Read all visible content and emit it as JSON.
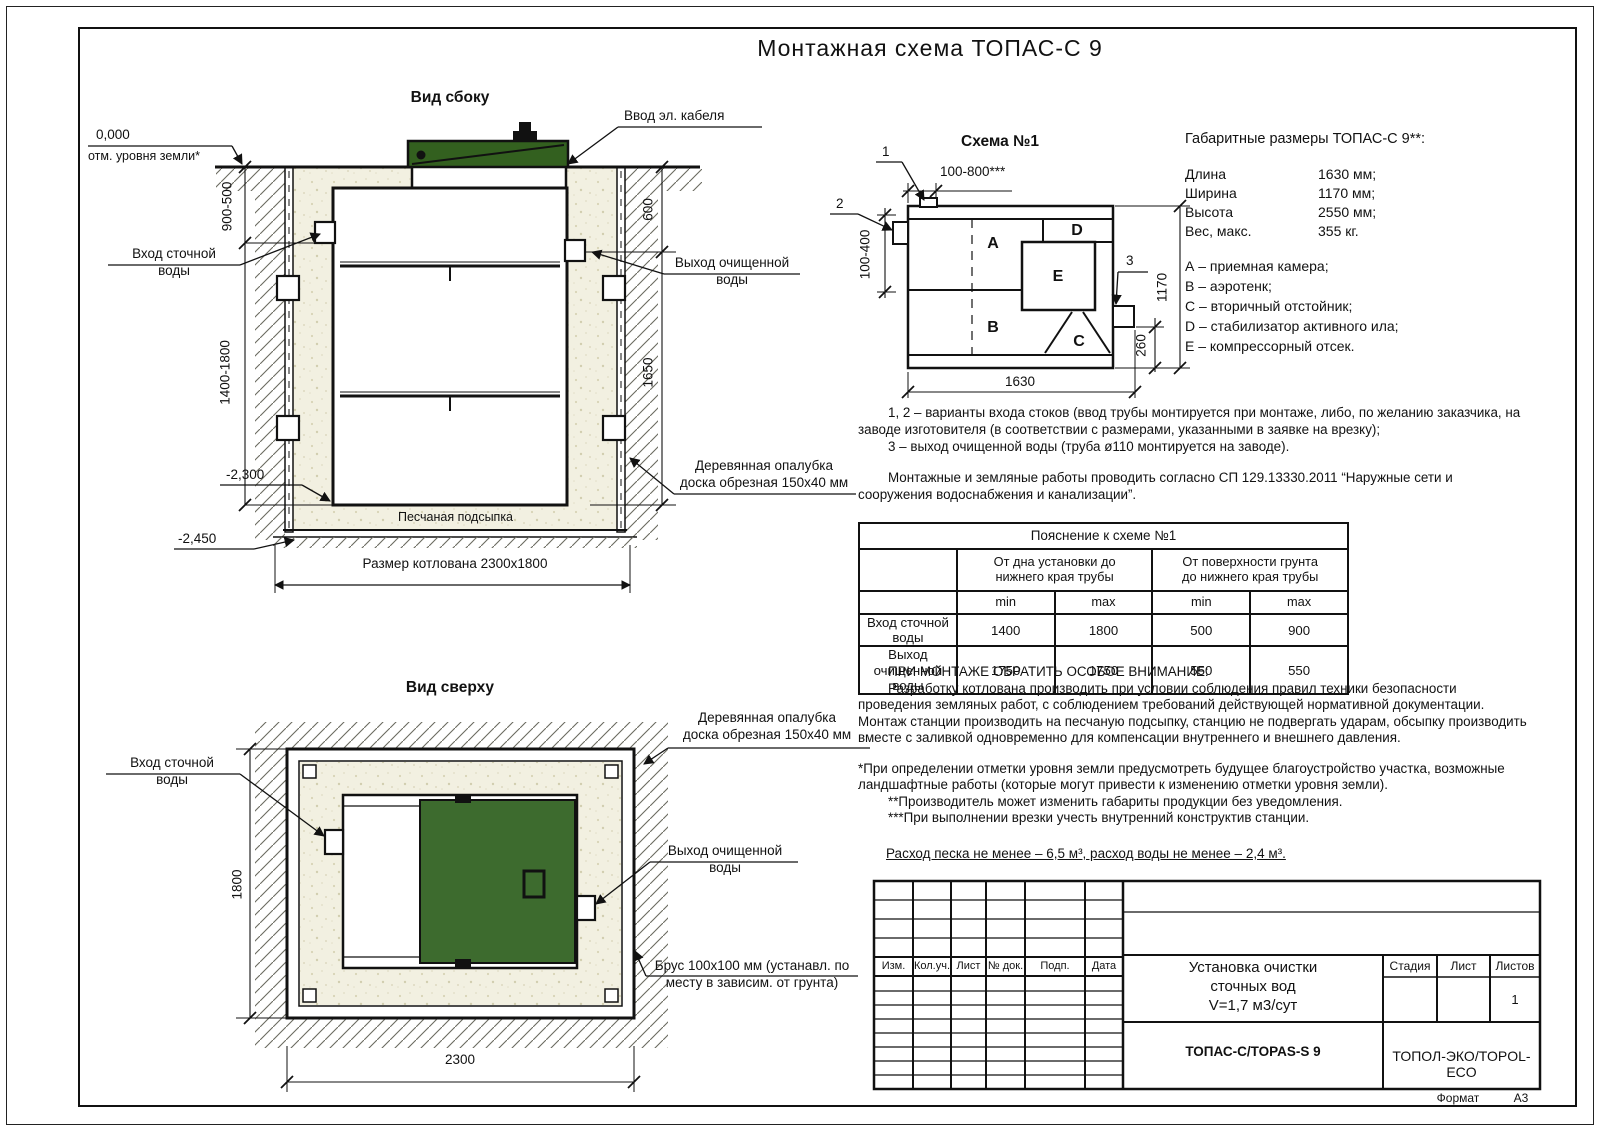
{
  "title": "Монтажная схема ТОПАС-С 9",
  "side_view": {
    "title": "Вид сбоку",
    "labels": {
      "zero_mark": "0,000",
      "ground_level": "отм. уровня земли*",
      "inlet": "Вход сточной\nводы",
      "cable_entry": "Ввод эл. кабеля",
      "outlet": "Выход очищенной\nводы",
      "formwork": "Деревянная опалубка\nдоска обрезная 150х40 мм",
      "sand_bed": "Песчаная подсыпка",
      "pit_size": "Размер котлована 2300х1800"
    },
    "dims": {
      "left_top": "900-500",
      "left_bottom": "1400-1800",
      "right_top": "600",
      "right_bottom": "1650",
      "depth_tank": "-2,300",
      "depth_pit": "-2,450"
    }
  },
  "top_view": {
    "title": "Вид сверху",
    "labels": {
      "inlet": "Вход сточной\nводы",
      "formwork": "Деревянная опалубка\nдоска обрезная 150х40 мм",
      "outlet": "Выход очищенной\nводы",
      "timber": "Брус 100х100 мм (устанавл. по\nместу в зависим. от грунта)"
    },
    "dims": {
      "width": "2300",
      "height": "1800"
    }
  },
  "schema1": {
    "title": "Схема №1",
    "callout1": "1",
    "callout2": "2",
    "callout3": "3",
    "letters": {
      "a": "A",
      "b": "B",
      "c": "C",
      "d": "D",
      "e": "E"
    },
    "dims": {
      "top": "100-800***",
      "left": "100-400",
      "right": "1170",
      "right2": "260",
      "bottom": "1630"
    }
  },
  "overall": {
    "title": "Габаритные размеры ТОПАС-С 9**:",
    "rows": [
      {
        "name": "Длина",
        "value": "1630 мм;"
      },
      {
        "name": "Ширина",
        "value": "1170 мм;"
      },
      {
        "name": "Высота",
        "value": "2550 мм;"
      },
      {
        "name": "Вес, макс.",
        "value": "355 кг."
      }
    ],
    "legend": [
      "А – приемная камера;",
      "В – аэротенк;",
      "С – вторичный отстойник;",
      "D – стабилизатор активного ила;",
      "Е – компрессорный отсек."
    ]
  },
  "notes": {
    "variants": "1, 2 – варианты входа  стоков (ввод трубы монтируется при монтаже, либо, по желанию заказчика, на заводе изготовителя (в соответствии с размерами, указанными в заявке на врезку);",
    "outlet_note": "3 – выход очищенной воды (труба ø110 монтируется на заводе).",
    "sp_note": "Монтажные и земляные работы проводить согласно СП 129.13330.2011 “Наружные сети и сооружения водоснабжения и канализации”."
  },
  "table": {
    "title": "Пояснение к схеме №1",
    "col_group1": "От дна установки до\nнижнего края трубы",
    "col_group2": "От поверхности грунта\nдо нижнего края трубы",
    "sub_headers": [
      "min",
      "max",
      "min",
      "max"
    ],
    "rows": [
      {
        "name": "Вход сточной воды",
        "values": [
          "1400",
          "1800",
          "500",
          "900"
        ]
      },
      {
        "name": "Выход очищенной воды",
        "values": [
          "1750",
          "1750",
          "550",
          "550"
        ]
      }
    ]
  },
  "attention": {
    "heading": "ПРИ МОНТАЖЕ ОБРАТИТЬ ОСОБОЕ ВНИМАНИЕ:",
    "p1": "Разработку котлована производить при условии соблюдения правил техники безопасности проведения земляных работ, с соблюдением требований действующей нормативной документации. Монтаж станции производить на песчаную подсыпку, станцию не подвергать ударам, обсыпку производить вместе с заливкой одновременно для компенсации внутреннего и внешнего давления.",
    "star1": "*При определении отметки уровня земли предусмотреть будущее благоустройство участка, возможные ландшафтные работы (которые могут привести к изменению отметки уровня земли).",
    "star2": "**Производитель может изменить габариты продукции без уведомления.",
    "star3": "***При выполнении врезки учесть внутренний конструктив станции.",
    "consumption": "Расход песка не менее – 6,5 м³, расход воды не менее – 2,4 м³."
  },
  "stamp": {
    "header_cols": [
      "Изм.",
      "Кол.уч.",
      "Лист",
      "№ док.",
      "Подп.",
      "Дата"
    ],
    "doc_title": "Установка очистки\nсточных вод\nV=1,7 м3/сут",
    "model": "ТОПАС-С/TOPAS-S 9",
    "stage_label": "Стадия",
    "sheet_label": "Лист",
    "sheets_label": "Листов",
    "sheets_value": "1",
    "company": "ТОПОЛ-ЭКО/TOPOL-ECO",
    "format_label": "Формат",
    "format_value": "А3"
  },
  "colors": {
    "lid_green_side": "#33601f",
    "lid_green_top": "#3d6b2e",
    "sand": "#f2f0e1"
  }
}
